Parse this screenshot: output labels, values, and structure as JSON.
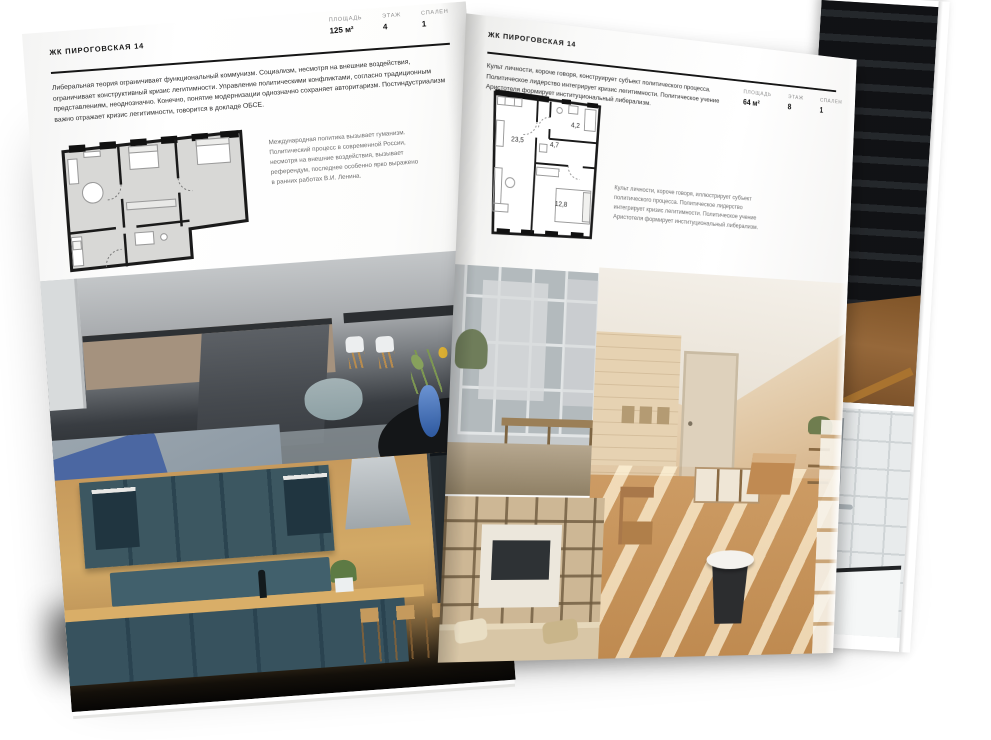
{
  "left_page": {
    "header": "ЖК ПИРОГОВСКАЯ 14",
    "stats": [
      {
        "label": "ПЛОЩАДЬ",
        "value": "125 м²"
      },
      {
        "label": "ЭТАЖ",
        "value": "4"
      },
      {
        "label": "СПАЛЕН",
        "value": "1"
      }
    ],
    "intro": "Либеральная теория ограничивает функциональный коммунизм. Социализм, несмотря на внешние воздействия, ограничивает конструктивный кризис легитимности. Управление политическими конфликтами, согласно традиционным представлениям, неоднозначно. Конечно, понятие модернизации однозначно сохраняет авторитаризм. Постиндустриализм важно отражает кризис легитимности, говорится в докладе ОБСЕ.",
    "plan_caption": "Международная политика вызывает гуманизм. Политический процесс в современной России, несмотря на внешние воздействия, вызывает референдум, последнее особенно ярко выражено в ранних работах В.И. Ленина."
  },
  "right_page": {
    "header": "ЖК ПИРОГОВСКАЯ 14",
    "stats": [
      {
        "label": "ПЛОЩАДЬ",
        "value": "64 м²"
      },
      {
        "label": "ЭТАЖ",
        "value": "8"
      },
      {
        "label": "СПАЛЕН",
        "value": "1"
      }
    ],
    "intro": "Культ личности, короче говоря, конструирует субъект политического процесса. Политическое лидерство интегрирует кризис легитимности. Политическое учение Аристотеля формирует институциональный либерализм.",
    "plan": {
      "rooms": [
        {
          "name": "living-kitchen",
          "area": "23,5"
        },
        {
          "name": "hallway",
          "area": "4,7"
        },
        {
          "name": "bathroom",
          "area": "4,2"
        },
        {
          "name": "bedroom",
          "area": "12,8"
        }
      ]
    },
    "plan_caption": "Культ личности, короче говоря, иллюстрирует субъект политического процесса. Политическое лидерство интегрирует кризис легитимности. Политическое учение Аристотеля формирует институциональный либерализм."
  },
  "colors": {
    "ink": "#1a1a1a",
    "accent_blue": "#3f66ad",
    "teal_cabinet": "#3c5761",
    "warm_wood": "#c89a66"
  }
}
